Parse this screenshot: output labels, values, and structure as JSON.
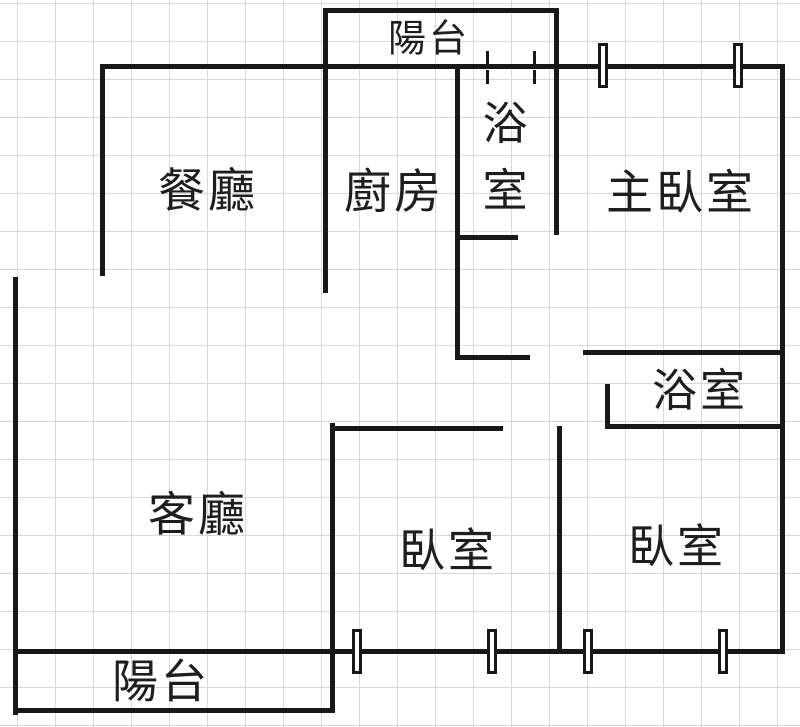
{
  "floorplan": {
    "canvas": {
      "width": 800,
      "height": 727,
      "background": "#ffffff"
    },
    "grid": {
      "spacing": 38,
      "color": "#d8d8d8",
      "offset_x": 17,
      "offset_y": 3
    },
    "wall_color": "#181818",
    "text_color": "#1e1e1e",
    "rooms": [
      {
        "id": "top-balcony",
        "label": "陽台",
        "cx": 429,
        "cy": 39,
        "font": 38
      },
      {
        "id": "dining-room",
        "label": "餐廳",
        "cx": 208,
        "cy": 192,
        "font": 47
      },
      {
        "id": "kitchen",
        "label": "廚房",
        "cx": 394,
        "cy": 193,
        "font": 47
      },
      {
        "id": "bathroom-1",
        "label": "浴室",
        "cx": 505,
        "cy": 157,
        "font": 45,
        "stacked": true
      },
      {
        "id": "master-bedroom",
        "label": "主臥室",
        "cx": 681,
        "cy": 194,
        "font": 47
      },
      {
        "id": "bathroom-2",
        "label": "浴室",
        "cx": 700,
        "cy": 391,
        "font": 45
      },
      {
        "id": "living-room",
        "label": "客廳",
        "cx": 198,
        "cy": 516,
        "font": 47
      },
      {
        "id": "bedroom-1",
        "label": "臥室",
        "cx": 448,
        "cy": 551,
        "font": 46
      },
      {
        "id": "bedroom-2",
        "label": "臥室",
        "cx": 677,
        "cy": 547,
        "font": 46
      },
      {
        "id": "bottom-balcony",
        "label": "陽台",
        "cx": 161,
        "cy": 682,
        "font": 46
      }
    ],
    "walls": [
      {
        "name": "top-outer-wall",
        "x": 100,
        "y": 64,
        "w": 685,
        "h": 5
      },
      {
        "name": "right-outer-wall",
        "x": 780,
        "y": 64,
        "w": 5,
        "h": 589
      },
      {
        "name": "bottom-outer-wall",
        "x": 13,
        "y": 649,
        "w": 772,
        "h": 5
      },
      {
        "name": "left-outer-wall",
        "x": 13,
        "y": 277,
        "w": 5,
        "h": 438
      },
      {
        "name": "balcony-bottom-wall",
        "x": 13,
        "y": 708,
        "w": 322,
        "h": 5
      },
      {
        "name": "dining-room-left-wall",
        "x": 100,
        "y": 64,
        "w": 5,
        "h": 212
      },
      {
        "name": "top-balcony-top-wall",
        "x": 323,
        "y": 8,
        "w": 236,
        "h": 5
      },
      {
        "name": "kitchen-left-wall",
        "x": 323,
        "y": 8,
        "w": 5,
        "h": 285
      },
      {
        "name": "bathroom1-right-wall",
        "x": 554,
        "y": 8,
        "w": 5,
        "h": 227
      },
      {
        "name": "kitchen-right-wall",
        "x": 455,
        "y": 64,
        "w": 5,
        "h": 296
      },
      {
        "name": "bathroom1-bottom-wall",
        "x": 455,
        "y": 235,
        "w": 63,
        "h": 5
      },
      {
        "name": "hallway-wall",
        "x": 455,
        "y": 355,
        "w": 75,
        "h": 5
      },
      {
        "name": "master-bedroom-bottom-wall",
        "x": 583,
        "y": 350,
        "w": 202,
        "h": 5
      },
      {
        "name": "bathroom2-left-wall",
        "x": 605,
        "y": 384,
        "w": 5,
        "h": 45
      },
      {
        "name": "bathroom2-bottom-wall",
        "x": 605,
        "y": 424,
        "w": 180,
        "h": 5
      },
      {
        "name": "bedroom1-top-wall",
        "x": 330,
        "y": 426,
        "w": 173,
        "h": 5
      },
      {
        "name": "bedroom1-left-wall",
        "x": 330,
        "y": 423,
        "w": 5,
        "h": 290
      },
      {
        "name": "bedroom-divider-wall",
        "x": 557,
        "y": 426,
        "w": 5,
        "h": 227
      }
    ],
    "windows": [
      {
        "name": "master-bedroom-window-left",
        "x": 598,
        "y": 43,
        "w": 10,
        "h": 45
      },
      {
        "name": "master-bedroom-window-right",
        "x": 733,
        "y": 43,
        "w": 10,
        "h": 45
      },
      {
        "name": "bedroom1-window-left",
        "x": 352,
        "y": 629,
        "w": 10,
        "h": 45
      },
      {
        "name": "bedroom1-window-right",
        "x": 487,
        "y": 629,
        "w": 10,
        "h": 45
      },
      {
        "name": "bedroom2-window-left",
        "x": 583,
        "y": 629,
        "w": 10,
        "h": 45
      },
      {
        "name": "bedroom2-window-right",
        "x": 718,
        "y": 629,
        "w": 10,
        "h": 45
      }
    ],
    "window_ticks": [
      {
        "name": "bathroom1-opening-tick",
        "x": 486,
        "y": 51,
        "w": 3,
        "h": 13
      },
      {
        "name": "bathroom1-opening-tick",
        "x": 486,
        "y": 70,
        "w": 3,
        "h": 14
      },
      {
        "name": "bathroom1-opening-tick",
        "x": 533,
        "y": 51,
        "w": 3,
        "h": 13
      },
      {
        "name": "bathroom1-opening-tick",
        "x": 533,
        "y": 70,
        "w": 3,
        "h": 14
      }
    ]
  }
}
